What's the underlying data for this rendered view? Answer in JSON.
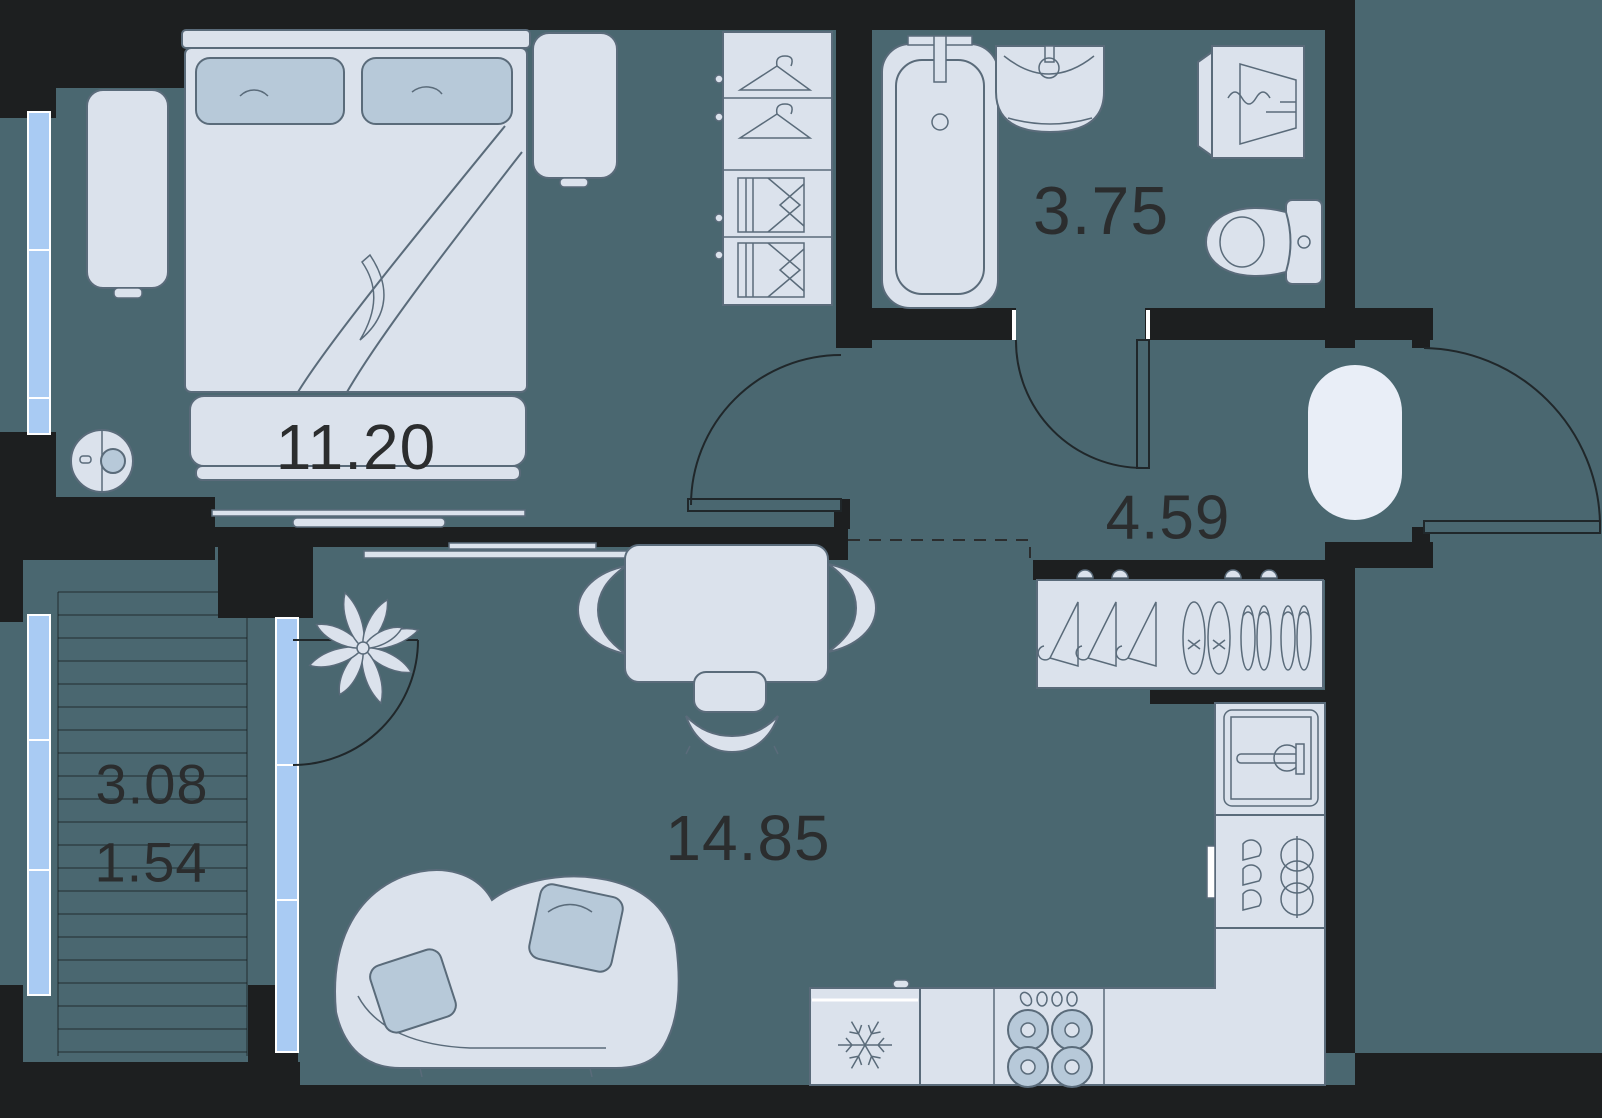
{
  "plan": {
    "title": "apartment-floor-plan",
    "rooms": {
      "bedroom": {
        "name": "bedroom",
        "area": "11.20"
      },
      "bathroom": {
        "name": "bathroom",
        "area": "3.75"
      },
      "hallway": {
        "name": "hallway",
        "area": "4.59"
      },
      "living": {
        "name": "living-kitchen",
        "area": "14.85"
      },
      "balcony": {
        "name": "balcony",
        "area_total": "3.08",
        "area_counted": "1.54"
      }
    }
  },
  "colors": {
    "floor": "#4a6770",
    "wall": "#1d1f20",
    "furniture": "#dbe2ec",
    "furniture-stroke": "#5a6b7a",
    "accent": "#b7c9d9",
    "window": "#a9cbf3",
    "pouf": "#e9eef7",
    "text": "#2b2d2e"
  }
}
